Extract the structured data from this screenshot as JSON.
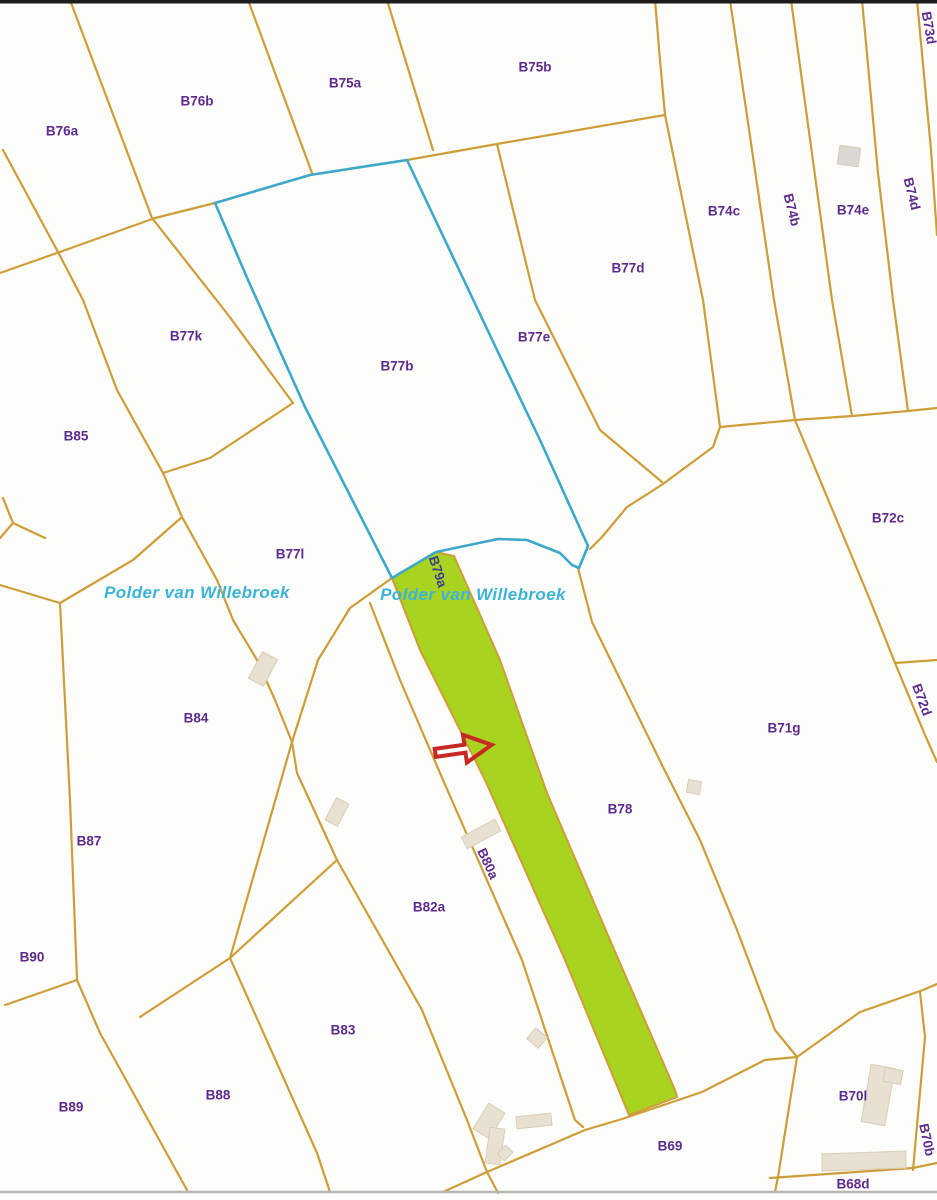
{
  "map": {
    "title": "Cadastral parcel map",
    "colors": {
      "background": "#fdfdfc",
      "boundary": "#cd9d38",
      "selection_blue": "#3da8c9",
      "highlight_green": "#a8d420",
      "label_purple": "#5e2b8d",
      "label_navy": "#3e3e8e",
      "water_text": "#3bb3d8",
      "arrow_red": "#c62822",
      "building_fill": "#e8e1d2",
      "building_stroke": "#d8cdb6",
      "building_gray": "#d9d8d3",
      "top_border": "#1c1c1c",
      "bottom_line": "#b5b5b5"
    },
    "area_texts": [
      {
        "text": "Polder van Willebroek",
        "x": 197,
        "y": 598
      },
      {
        "text": "Polder van Willebroek",
        "x": 473,
        "y": 600
      }
    ],
    "parcel_labels": [
      {
        "text": "B76a",
        "x": 62,
        "y": 132,
        "rot": 0
      },
      {
        "text": "B76b",
        "x": 197,
        "y": 102,
        "rot": 0
      },
      {
        "text": "B75a",
        "x": 345,
        "y": 84,
        "rot": 0
      },
      {
        "text": "B75b",
        "x": 535,
        "y": 68,
        "rot": 0
      },
      {
        "text": "B73d",
        "x": 928,
        "y": 28,
        "rot": 80
      },
      {
        "text": "B74c",
        "x": 724,
        "y": 212,
        "rot": 0
      },
      {
        "text": "B74b",
        "x": 791,
        "y": 210,
        "rot": 76
      },
      {
        "text": "B74e",
        "x": 853,
        "y": 211,
        "rot": 0
      },
      {
        "text": "B74d",
        "x": 911,
        "y": 194,
        "rot": 76
      },
      {
        "text": "B77d",
        "x": 628,
        "y": 269,
        "rot": 0
      },
      {
        "text": "B77k",
        "x": 186,
        "y": 337,
        "rot": 0
      },
      {
        "text": "B77b",
        "x": 397,
        "y": 367,
        "rot": 0
      },
      {
        "text": "B77e",
        "x": 534,
        "y": 338,
        "rot": 0
      },
      {
        "text": "B85",
        "x": 76,
        "y": 437,
        "rot": 0
      },
      {
        "text": "B77l",
        "x": 290,
        "y": 555,
        "rot": 0
      },
      {
        "text": "B72c",
        "x": 888,
        "y": 519,
        "rot": 0
      },
      {
        "text": "B79a",
        "x": 437,
        "y": 572,
        "rot": 72,
        "navy": true
      },
      {
        "text": "B84",
        "x": 196,
        "y": 719,
        "rot": 0
      },
      {
        "text": "B71g",
        "x": 784,
        "y": 729,
        "rot": 0
      },
      {
        "text": "B72d",
        "x": 921,
        "y": 700,
        "rot": 70
      },
      {
        "text": "B78",
        "x": 620,
        "y": 810,
        "rot": 0
      },
      {
        "text": "B87",
        "x": 89,
        "y": 842,
        "rot": 0
      },
      {
        "text": "B80a",
        "x": 487,
        "y": 864,
        "rot": 65
      },
      {
        "text": "B82a",
        "x": 429,
        "y": 908,
        "rot": 0
      },
      {
        "text": "B90",
        "x": 32,
        "y": 958,
        "rot": 0
      },
      {
        "text": "B83",
        "x": 343,
        "y": 1031,
        "rot": 0
      },
      {
        "text": "B88",
        "x": 218,
        "y": 1096,
        "rot": 0
      },
      {
        "text": "B89",
        "x": 71,
        "y": 1108,
        "rot": 0
      },
      {
        "text": "B69",
        "x": 670,
        "y": 1147,
        "rot": 0
      },
      {
        "text": "B70l",
        "x": 853,
        "y": 1097,
        "rot": 0
      },
      {
        "text": "B70b",
        "x": 926,
        "y": 1140,
        "rot": 78
      },
      {
        "text": "B68d",
        "x": 853,
        "y": 1185,
        "rot": 0
      }
    ],
    "boundary_lines": [
      [
        [
          70,
          0
        ],
        [
          152,
          218
        ]
      ],
      [
        [
          248,
          0
        ],
        [
          312,
          173
        ]
      ],
      [
        [
          387,
          0
        ],
        [
          433,
          150
        ]
      ],
      [
        [
          3,
          150
        ],
        [
          58,
          252
        ],
        [
          83,
          300
        ],
        [
          117,
          390
        ],
        [
          163,
          473
        ],
        [
          182,
          517
        ],
        [
          217,
          580
        ],
        [
          233,
          620
        ],
        [
          257,
          660
        ],
        [
          275,
          700
        ],
        [
          292,
          742
        ]
      ],
      [
        [
          0,
          273
        ],
        [
          57,
          253
        ],
        [
          155,
          218
        ],
        [
          215,
          203
        ]
      ],
      [
        [
          215,
          203
        ],
        [
          310,
          175
        ],
        [
          407,
          160
        ]
      ],
      [
        [
          407,
          160
        ],
        [
          497,
          144
        ],
        [
          665,
          115
        ]
      ],
      [
        [
          655,
          0
        ],
        [
          660,
          60
        ],
        [
          665,
          115
        ]
      ],
      [
        [
          665,
          115
        ],
        [
          703,
          300
        ],
        [
          720,
          427
        ]
      ],
      [
        [
          730,
          0
        ],
        [
          774,
          300
        ],
        [
          795,
          420
        ]
      ],
      [
        [
          791,
          0
        ],
        [
          832,
          300
        ],
        [
          852,
          416
        ]
      ],
      [
        [
          862,
          0
        ],
        [
          878,
          173
        ],
        [
          893,
          300
        ],
        [
          908,
          411
        ]
      ],
      [
        [
          917,
          0
        ],
        [
          931,
          150
        ],
        [
          937,
          235
        ]
      ],
      [
        [
          720,
          427
        ],
        [
          795,
          420
        ],
        [
          852,
          416
        ],
        [
          908,
          411
        ],
        [
          937,
          408
        ]
      ],
      [
        [
          795,
          420
        ],
        [
          870,
          600
        ],
        [
          895,
          663
        ]
      ],
      [
        [
          895,
          663
        ],
        [
          937,
          660
        ]
      ],
      [
        [
          895,
          663
        ],
        [
          925,
          735
        ],
        [
          937,
          762
        ]
      ],
      [
        [
          720,
          427
        ],
        [
          713,
          447
        ],
        [
          663,
          484
        ],
        [
          627,
          507
        ],
        [
          602,
          537
        ],
        [
          590,
          549
        ]
      ],
      [
        [
          578,
          568
        ],
        [
          592,
          622
        ],
        [
          663,
          767
        ],
        [
          700,
          840
        ],
        [
          737,
          930
        ],
        [
          775,
          1030
        ],
        [
          797,
          1057
        ]
      ],
      [
        [
          497,
          144
        ],
        [
          535,
          300
        ],
        [
          600,
          430
        ],
        [
          662,
          482
        ]
      ],
      [
        [
          152,
          218
        ],
        [
          229,
          316
        ],
        [
          293,
          403
        ]
      ],
      [
        [
          163,
          473
        ],
        [
          210,
          458
        ],
        [
          293,
          403
        ]
      ],
      [
        [
          0,
          585
        ],
        [
          60,
          603
        ]
      ],
      [
        [
          60,
          603
        ],
        [
          70,
          800
        ],
        [
          77,
          980
        ],
        [
          100,
          1033
        ],
        [
          187,
          1190
        ]
      ],
      [
        [
          5,
          1005
        ],
        [
          77,
          980
        ]
      ],
      [
        [
          182,
          517
        ],
        [
          133,
          560
        ],
        [
          60,
          603
        ]
      ],
      [
        [
          292,
          742
        ],
        [
          230,
          958
        ],
        [
          317,
          1153
        ],
        [
          330,
          1192
        ]
      ],
      [
        [
          140,
          1017
        ],
        [
          230,
          958
        ],
        [
          337,
          860
        ]
      ],
      [
        [
          292,
          742
        ],
        [
          297,
          773
        ],
        [
          337,
          860
        ],
        [
          422,
          1010
        ],
        [
          467,
          1120
        ],
        [
          487,
          1172
        ]
      ],
      [
        [
          392,
          578
        ],
        [
          350,
          608
        ],
        [
          318,
          660
        ],
        [
          292,
          742
        ]
      ],
      [
        [
          370,
          603
        ],
        [
          400,
          680
        ],
        [
          443,
          780
        ],
        [
          522,
          960
        ],
        [
          575,
          1120
        ],
        [
          583,
          1127
        ]
      ],
      [
        [
          487,
          1172
        ],
        [
          585,
          1130
        ],
        [
          622,
          1119
        ],
        [
          702,
          1092
        ],
        [
          765,
          1060
        ],
        [
          797,
          1057
        ],
        [
          860,
          1012
        ],
        [
          923,
          990
        ],
        [
          937,
          984
        ]
      ],
      [
        [
          797,
          1057
        ],
        [
          778,
          1177
        ],
        [
          775,
          1192
        ]
      ],
      [
        [
          770,
          1178
        ],
        [
          913,
          1168
        ],
        [
          937,
          1163
        ]
      ],
      [
        [
          920,
          992
        ],
        [
          925,
          1037
        ],
        [
          913,
          1170
        ]
      ],
      [
        [
          443,
          1192
        ],
        [
          487,
          1172
        ]
      ],
      [
        [
          487,
          1172
        ],
        [
          498,
          1193
        ]
      ],
      [
        [
          3,
          498
        ],
        [
          13,
          523
        ],
        [
          45,
          538
        ]
      ],
      [
        [
          13,
          523
        ],
        [
          0,
          538
        ]
      ]
    ],
    "selected_parcel_outline": [
      [
        215,
        203
      ],
      [
        310,
        175
      ],
      [
        407,
        160
      ],
      [
        497,
        350
      ],
      [
        540,
        440
      ],
      [
        588,
        546
      ],
      [
        579,
        568
      ],
      [
        572,
        565
      ],
      [
        560,
        553
      ],
      [
        527,
        540
      ],
      [
        498,
        539
      ],
      [
        436,
        552
      ],
      [
        392,
        578
      ],
      [
        305,
        407
      ],
      [
        248,
        280
      ]
    ],
    "highlighted_parcel": [
      [
        392,
        578
      ],
      [
        436,
        552
      ],
      [
        454,
        556
      ],
      [
        500,
        660
      ],
      [
        547,
        793
      ],
      [
        610,
        940
      ],
      [
        675,
        1090
      ],
      [
        677,
        1097
      ],
      [
        629,
        1115
      ],
      [
        565,
        960
      ],
      [
        485,
        780
      ],
      [
        420,
        650
      ]
    ],
    "buildings": [
      {
        "x": 849,
        "y": 156,
        "w": 21,
        "h": 19,
        "rot": 8,
        "gray": true
      },
      {
        "x": 263,
        "y": 669,
        "w": 17,
        "h": 30,
        "rot": 28
      },
      {
        "x": 337,
        "y": 812,
        "w": 14,
        "h": 25,
        "rot": 28
      },
      {
        "x": 694,
        "y": 787,
        "w": 13,
        "h": 13,
        "rot": 10
      },
      {
        "x": 481,
        "y": 834,
        "w": 13,
        "h": 38,
        "rot": 62
      },
      {
        "x": 537,
        "y": 1038,
        "w": 15,
        "h": 14,
        "rot": 40
      },
      {
        "x": 489,
        "y": 1121,
        "w": 19,
        "h": 30,
        "rot": 32
      },
      {
        "x": 495,
        "y": 1146,
        "w": 15,
        "h": 36,
        "rot": 8
      },
      {
        "x": 505,
        "y": 1153,
        "w": 10,
        "h": 12,
        "rot": 45
      },
      {
        "x": 534,
        "y": 1121,
        "w": 35,
        "h": 12,
        "rot": -6
      },
      {
        "x": 878,
        "y": 1095,
        "w": 24,
        "h": 58,
        "rot": 10
      },
      {
        "x": 893,
        "y": 1076,
        "w": 18,
        "h": 14,
        "rot": 10
      },
      {
        "x": 864,
        "y": 1161,
        "w": 84,
        "h": 17,
        "rot": -2
      }
    ],
    "arrow": {
      "x": 433,
      "y": 737,
      "rot": -8,
      "points": "0,12 30,12 30,2 57,16 30,30 30,20 0,20"
    }
  }
}
